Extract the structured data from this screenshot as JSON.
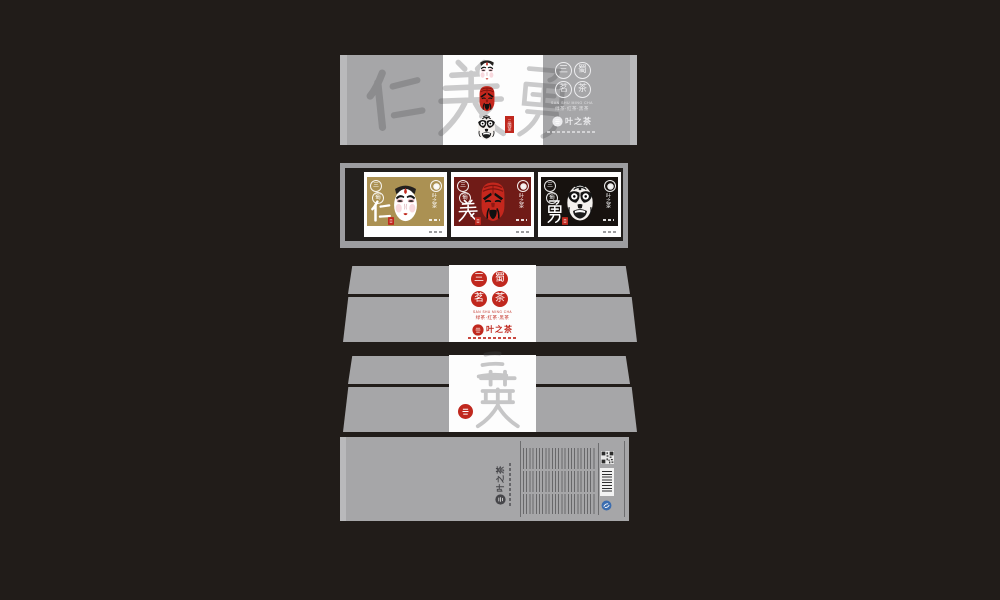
{
  "colors": {
    "bg": "#211c19",
    "panel": "#a6a6a8",
    "paneledge": "#bcbcbe",
    "white": "#fdfdfd",
    "sealred": "#c0281e",
    "facered": "#c5271d",
    "gold": "#ab9153",
    "darkred": "#701b17",
    "cardblack": "#17120f",
    "framedark": "#211e1c",
    "framegray": "#9d9da0",
    "qsblue": "#3b6db0"
  },
  "brand": {
    "name": "叶之茶"
  },
  "front_wrap": {
    "seal_title": [
      "三",
      "蜀",
      "茗",
      "茶"
    ],
    "caption_en": "SAN SHU MING CHA",
    "caption_cn": "绿茶·红茶·黑茶",
    "side_tag": "三国茶",
    "watermark": "仁義勇",
    "masks": [
      "white-face-mask",
      "red-face-mask",
      "black-face-mask"
    ]
  },
  "tray": {
    "cards": [
      {
        "virtue": "仁",
        "bg": "#ab9153",
        "mask": "white-face-mask"
      },
      {
        "virtue": "義",
        "bg": "#701b17",
        "mask": "red-face-mask"
      },
      {
        "virtue": "勇",
        "bg": "#17120f",
        "mask": "black-face-mask"
      }
    ]
  },
  "sleeve": {
    "seal_title": [
      "三",
      "蜀",
      "茗",
      "茶"
    ],
    "caption_en": "SAN SHU MING CHA",
    "caption_cn": "绿茶·红茶·黑茶"
  },
  "inner_lid": {
    "watermark": "三英"
  },
  "back": {
    "logo": "叶之茶",
    "elements": [
      "product-info-text",
      "qr-code",
      "barcode",
      "qs-mark"
    ]
  }
}
